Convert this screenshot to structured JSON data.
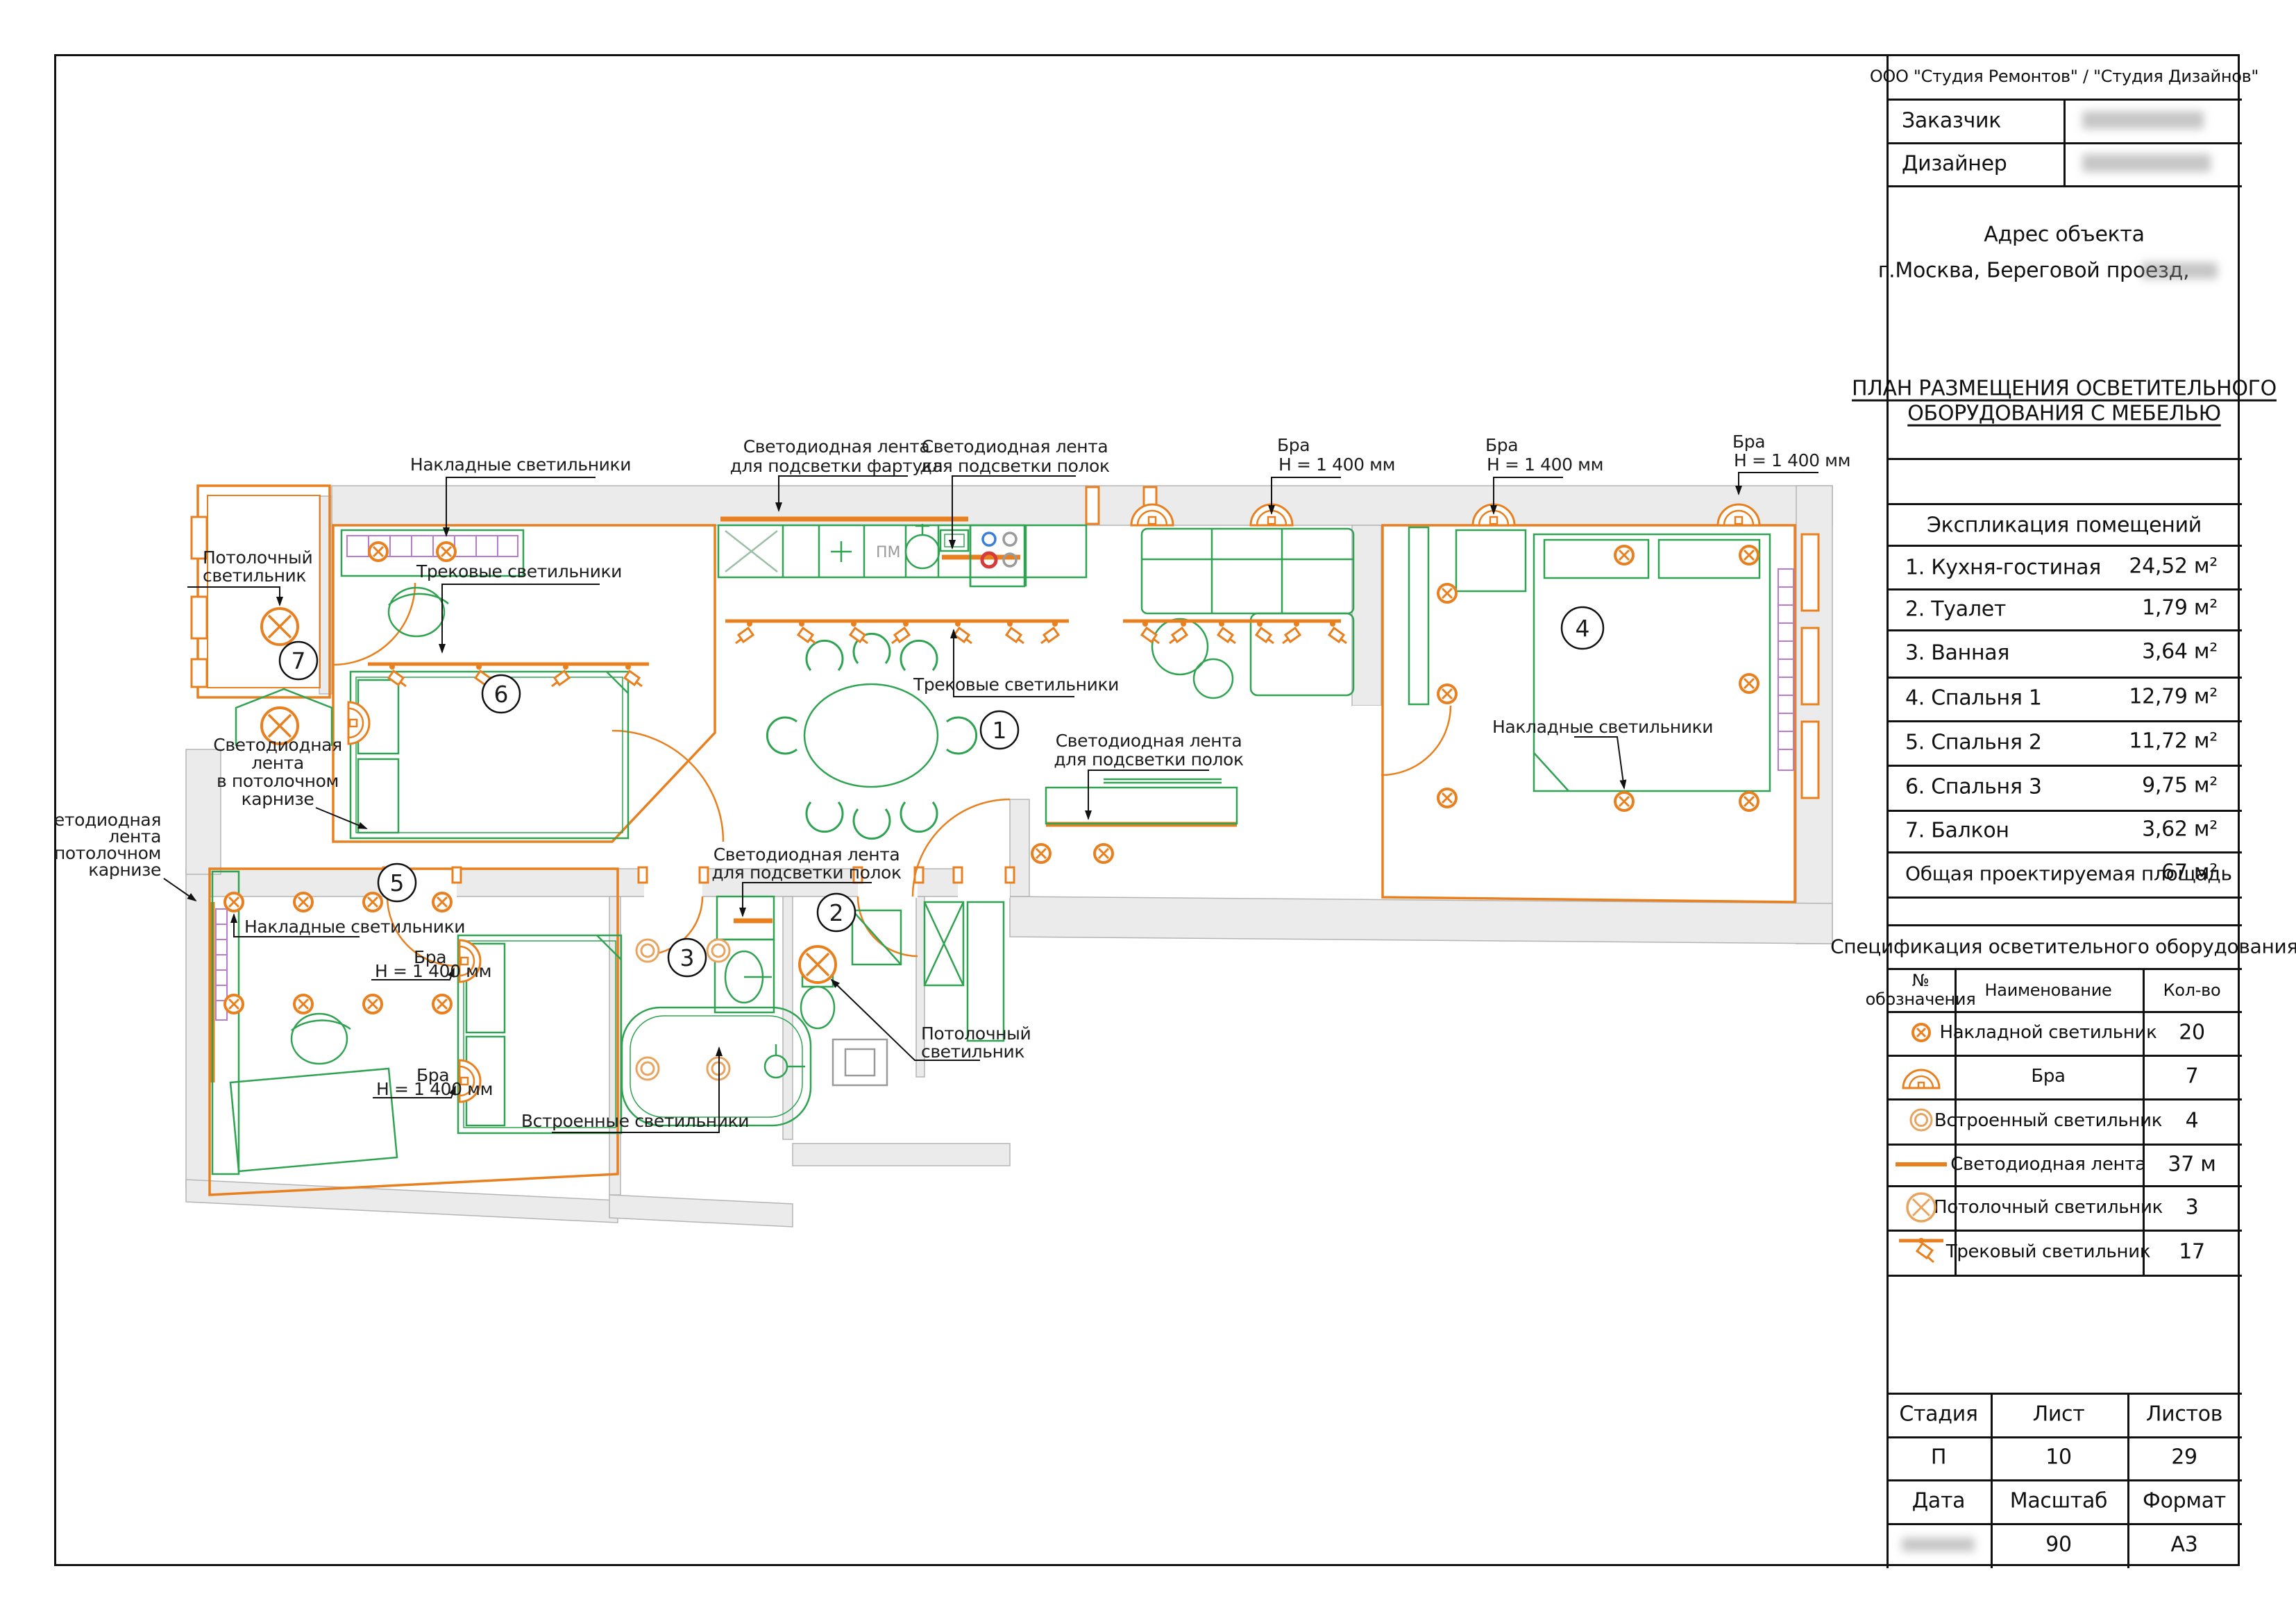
{
  "sheet": {
    "org_line": "ООО \"Студия Ремонтов\" / \"Студия Дизайнов\"",
    "customer_label": "Заказчик",
    "designer_label": "Дизайнер",
    "address_title": "Адрес объекта",
    "address_line": "г.Москва, Береговой проезд,",
    "title_line1": "ПЛАН РАЗМЕЩЕНИЯ ОСВЕТИТЕЛЬНОГО",
    "title_line2": "ОБОРУДОВАНИЯ С МЕБЕЛЬЮ"
  },
  "rooms_table": {
    "title": "Экспликация помещений",
    "rows": [
      {
        "name": "1. Кухня-гостиная",
        "area": "24,52 м²"
      },
      {
        "name": "2. Туалет",
        "area": "1,79 м²"
      },
      {
        "name": "3. Ванная",
        "area": "3,64 м²"
      },
      {
        "name": "4. Спальня 1",
        "area": "12,79 м²"
      },
      {
        "name": "5. Спальня 2",
        "area": "11,72 м²"
      },
      {
        "name": "6. Спальня 3",
        "area": "9,75 м²"
      },
      {
        "name": "7. Балкон",
        "area": "3,62 м²"
      }
    ],
    "total_label": "Общая проектируемая площадь",
    "total_area": "67 м²"
  },
  "spec_table": {
    "title": "Спецификация осветительного оборудования",
    "col_symbol_1": "№",
    "col_symbol_2": "обозначения",
    "col_name": "Наименование",
    "col_qty": "Кол-во",
    "rows": [
      {
        "symbol": "surface-light",
        "name": "Накладной светильник",
        "qty": "20"
      },
      {
        "symbol": "sconce",
        "name": "Бра",
        "qty": "7"
      },
      {
        "symbol": "recessed-light",
        "name": "Встроенный светильник",
        "qty": "4"
      },
      {
        "symbol": "led-strip",
        "name": "Светодиодная лента",
        "qty": "37 м"
      },
      {
        "symbol": "ceiling-light",
        "name": "Потолочный светильник",
        "qty": "3"
      },
      {
        "symbol": "track-light",
        "name": "Трековый светильник",
        "qty": "17"
      }
    ]
  },
  "stamp": {
    "stage_label": "Стадия",
    "sheet_label": "Лист",
    "sheets_label": "Листов",
    "stage": "П",
    "sheet": "10",
    "sheets": "29",
    "date_label": "Дата",
    "scale_label": "Масштаб",
    "format_label": "Формат",
    "scale": "90",
    "format": "А3"
  },
  "plan": {
    "room_numbers": {
      "n1": "1",
      "n2": "2",
      "n3": "3",
      "n4": "4",
      "n5": "5",
      "n6": "6",
      "n7": "7"
    },
    "labels": {
      "nakladnye": "Накладные светильники",
      "svetodiodnaya_lenta": "Светодиодная лента",
      "dlya_fartuka": "для подсветки фартука",
      "dlya_polok": "для подсветки полок",
      "bra": "Бра",
      "bra_h": "Н = 1 400 мм",
      "trekovye": "Трековые светильники",
      "vstroennye": "Встроенные светильники",
      "potolochny_1": "Потолочный",
      "potolochny_2": "светильник",
      "svetodiodnaya": "Светодиодная",
      "lenta": "лента",
      "v_potolochnom": "в потолочном",
      "karnize": "карнизе",
      "pm": "ПМ"
    },
    "colors": {
      "lighting": "#e8801f",
      "furniture": "#2fa351",
      "wall_fill": "#ebebeb",
      "wall_stroke": "#b5b5b5",
      "annotation": "#1c1c1c",
      "ladder": "#b97bd2"
    }
  }
}
